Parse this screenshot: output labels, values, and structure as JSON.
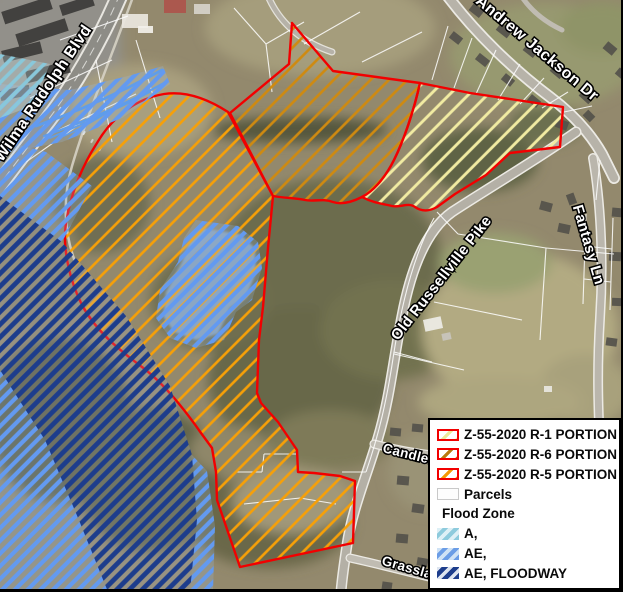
{
  "map": {
    "streets": {
      "wilma_rudolph_blvd": "Wilma Rudolph Blvd",
      "andrew_jackson_dr": "Andrew Jackson Dr",
      "fantasy_ln": "Fantasy Ln",
      "old_russellville_pike": "Old Russellville Pike",
      "candlewood": "Candlew",
      "grassland": "Grassland"
    },
    "zones": [
      {
        "id": "R-1",
        "label": "Z-55-2020 R-1 PORTION",
        "outline_color": "#f20000",
        "hatch_color": "#f1eba2"
      },
      {
        "id": "R-6",
        "label": "Z-55-2020 R-6 PORTION",
        "outline_color": "#f20000",
        "hatch_color": "#cf8a10"
      },
      {
        "id": "R-5",
        "label": "Z-55-2020 R-5 PORTION",
        "outline_color": "#f20000",
        "hatch_color": "#f7a007"
      }
    ],
    "flood_zones": [
      {
        "id": "A",
        "label": "A,",
        "stripe_color": "#89c8da"
      },
      {
        "id": "AE",
        "label": "AE,",
        "stripe_color": "#639af0"
      },
      {
        "id": "AE_FLOODWAY",
        "label": "AE, FLOODWAY",
        "stripe_color": "#1d3d8c"
      }
    ]
  },
  "legend": {
    "items": [
      {
        "label": "Z-55-2020 R-1 PORTION",
        "swatch": "zone-r1"
      },
      {
        "label": "Z-55-2020 R-6 PORTION",
        "swatch": "zone-r6"
      },
      {
        "label": "Z-55-2020 R-5 PORTION",
        "swatch": "zone-r5"
      },
      {
        "label": "Parcels",
        "swatch": "parcels"
      },
      {
        "label": "Flood Zone",
        "swatch": "none"
      },
      {
        "label": "A,",
        "swatch": "flood-a"
      },
      {
        "label": "AE,",
        "swatch": "flood-ae"
      },
      {
        "label": "AE, FLOODWAY",
        "swatch": "flood-floodway"
      }
    ]
  },
  "colors": {
    "zone_outline_red": "#f20000",
    "hatch_r1_yellow": "#f1eba2",
    "hatch_r6_dark_orange": "#cf8a10",
    "hatch_r5_orange": "#f7a007",
    "flood_a_cyan": "#89c8da",
    "flood_ae_blue": "#639af0",
    "flood_floodway_navy": "#1d3d8c",
    "legend_background": "#ffffff"
  }
}
